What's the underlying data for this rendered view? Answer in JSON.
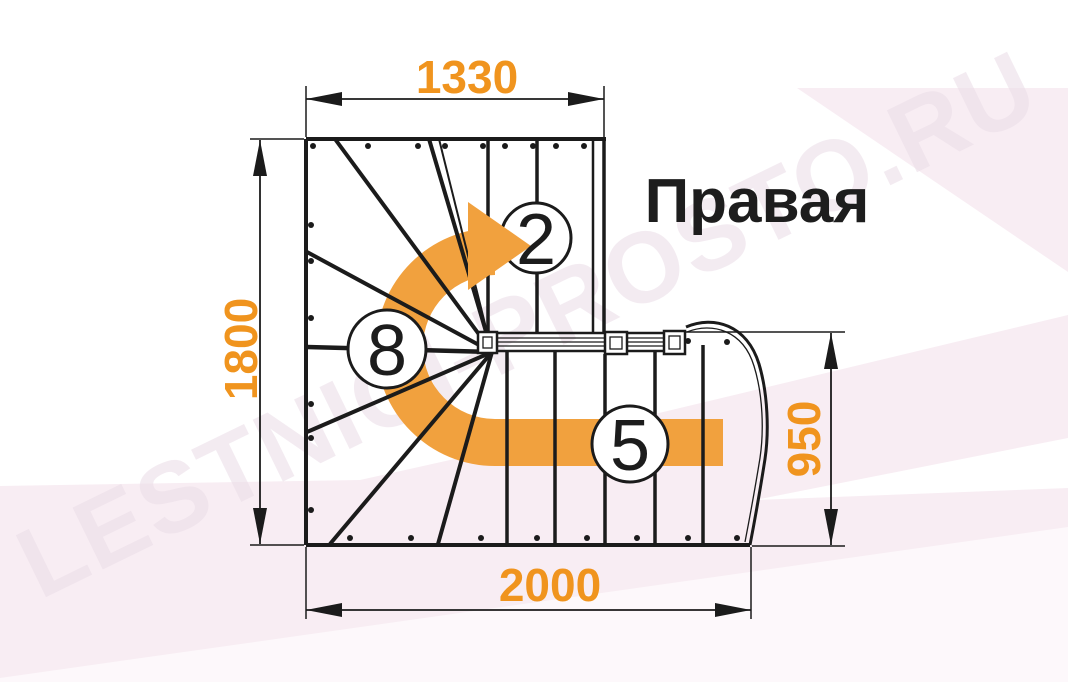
{
  "drawing": {
    "title_label": "Правая",
    "dimensions": {
      "width_top": "1330",
      "height_left": "1800",
      "height_right": "950",
      "width_bottom": "2000"
    },
    "step_counts": {
      "upper_flight": "2",
      "winder": "8",
      "lower_flight": "5"
    },
    "watermark_text": "LESTNICI-PROSTO.RU"
  },
  "colors": {
    "dimension_text": "#F0941E",
    "arrow_orange": "#F1A13E",
    "line": "#1B1B1B",
    "pink_tint": "#F8EDF3"
  }
}
